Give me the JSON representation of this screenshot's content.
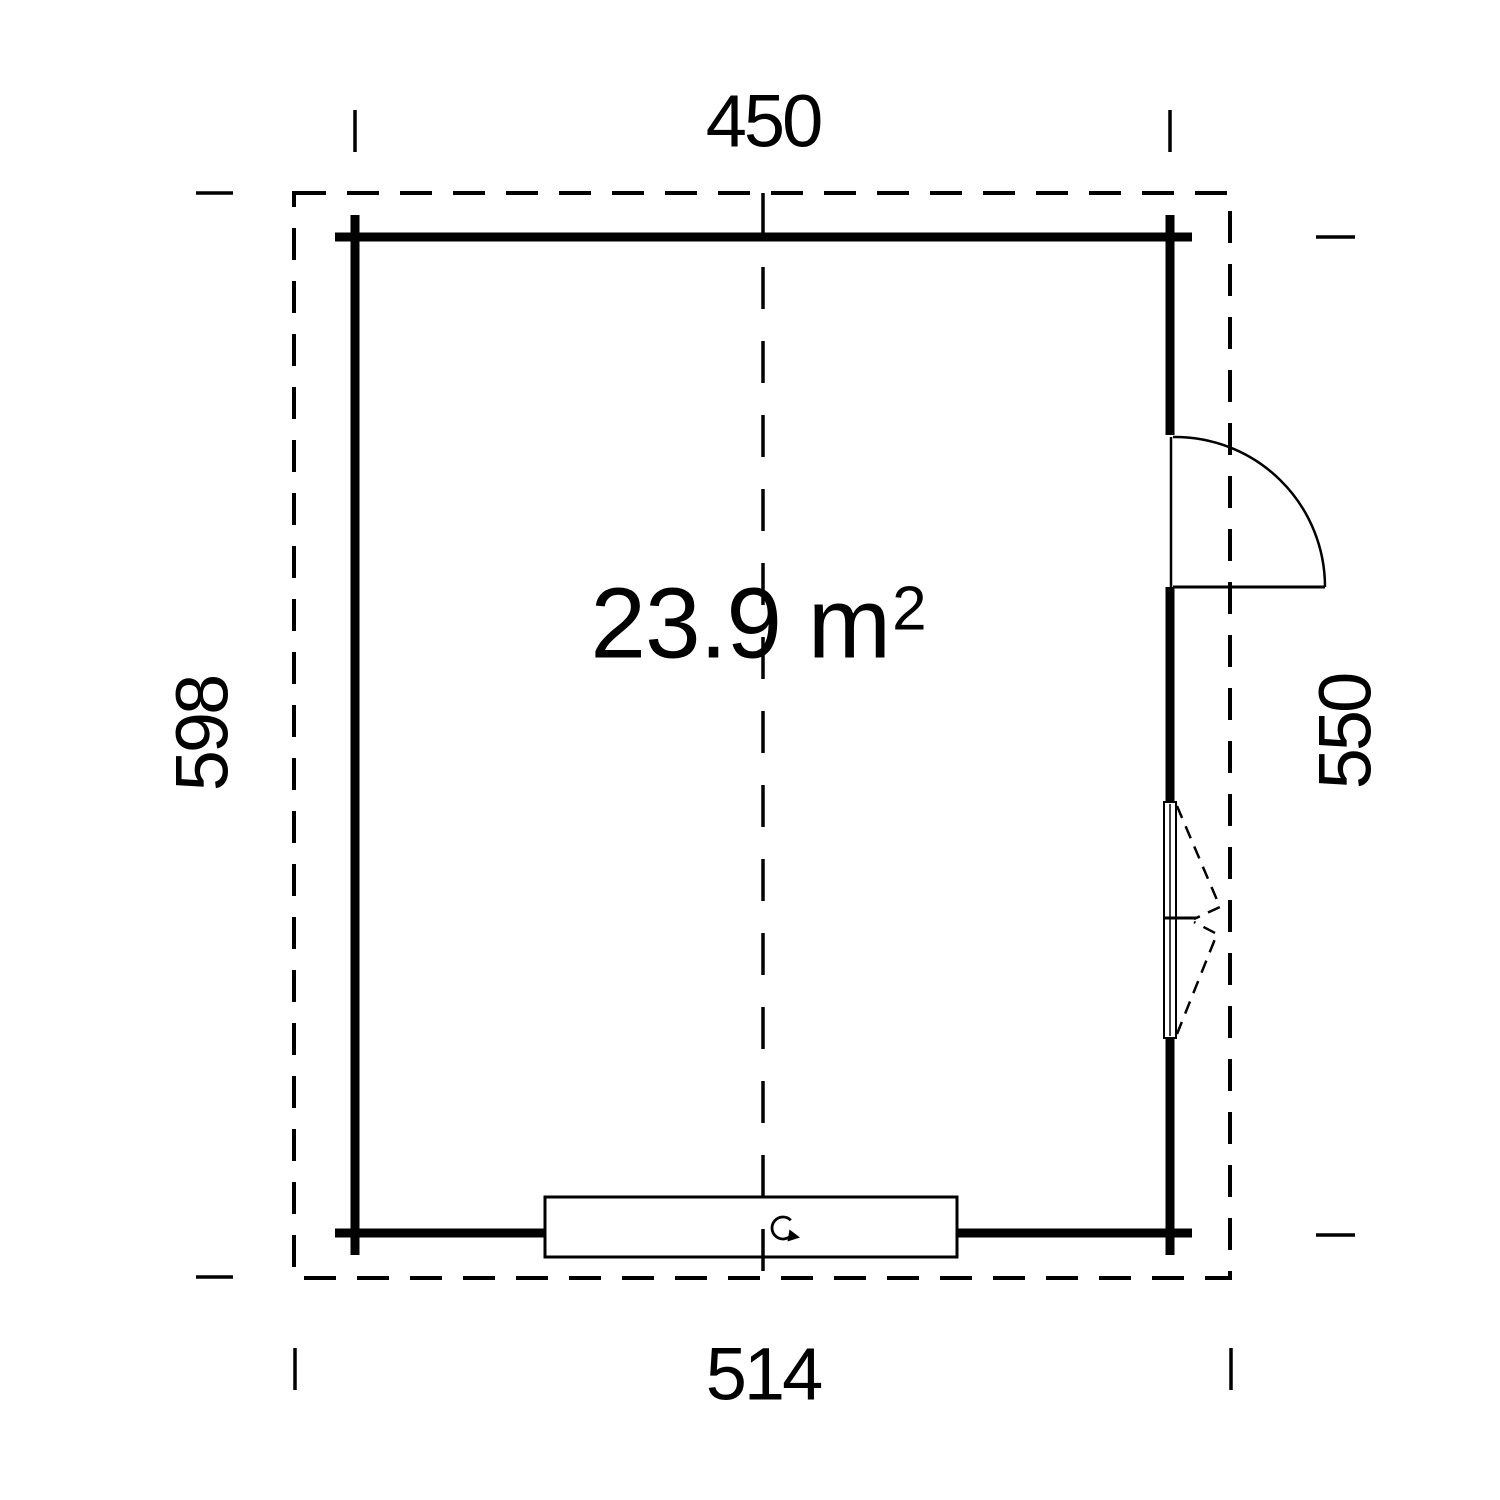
{
  "plan": {
    "area_label": {
      "value": "23.9 m",
      "superscript": "2"
    },
    "dimensions": {
      "width_top": "450",
      "depth_left": "598",
      "depth_right": "550",
      "width_bottom": "514"
    },
    "colors": {
      "line": "#000000",
      "background": "#ffffff"
    }
  }
}
